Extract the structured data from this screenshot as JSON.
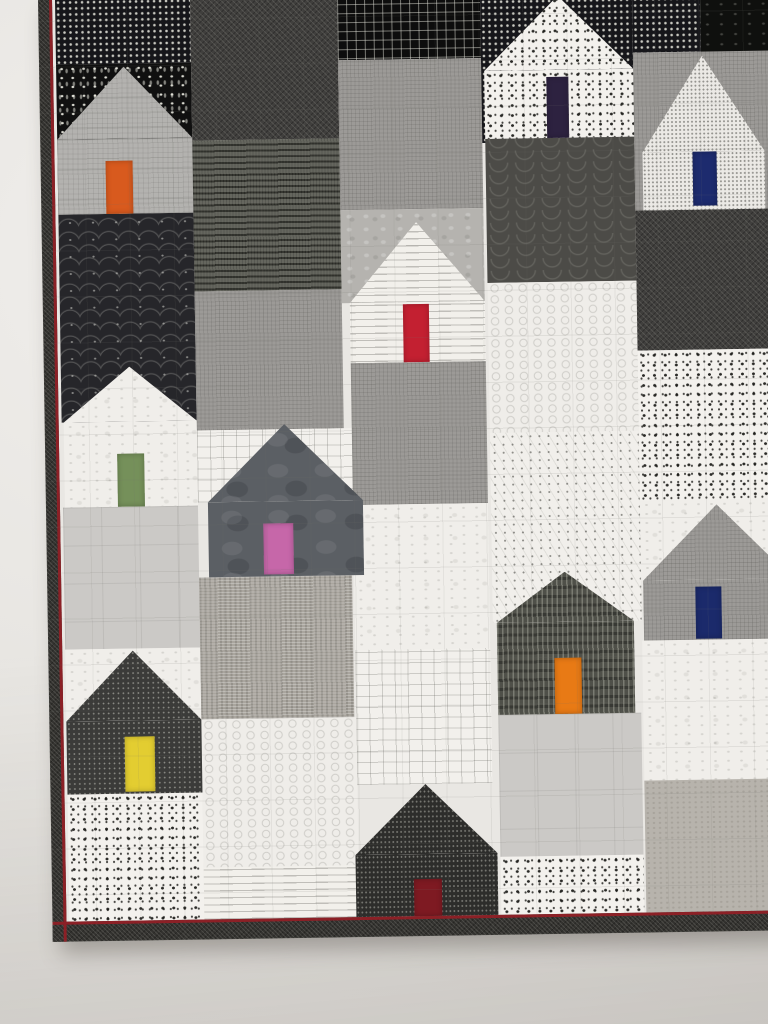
{
  "scene": {
    "description": "Photograph of a modern patchwork quilt hanging on a pale gray wall. The quilt is pieced from black, white and gray printed fabrics forming a village of house blocks; each house has one small bright solid-colored door. A dark binding with a thin dark-red accent line edges the quilt on the left and bottom.",
    "medium": "photograph",
    "subject": "house-block patchwork quilt",
    "text_content": "none"
  },
  "palette": {
    "wall": "#e7e5e1",
    "binding": "#33322f",
    "binding_accent": "#8c2026",
    "fabrics": [
      "#0d0d0d",
      "#16161a",
      "#3b3b39",
      "#45463f",
      "#5b5f64",
      "#9c9a97",
      "#b5b3af",
      "#cbc9c6",
      "#f0eeea",
      "#f3f1ed"
    ]
  },
  "houses": [
    {
      "id": "house-1",
      "position": "top-left",
      "body_fabric": "gray-crosshatch",
      "door_name": "orange",
      "door_color": "#d85a1e"
    },
    {
      "id": "house-2",
      "position": "top-center",
      "body_fabric": "white-with-black-dots",
      "door_name": "dark-plum",
      "door_color": "#2d2240"
    },
    {
      "id": "house-3",
      "position": "top-right",
      "body_fabric": "white-speckle",
      "door_name": "navy-blue",
      "door_color": "#1d2b6e"
    },
    {
      "id": "house-4",
      "position": "middle-left",
      "body_fabric": "white-grunge",
      "door_name": "moss-green",
      "door_color": "#75905a"
    },
    {
      "id": "house-5",
      "position": "center",
      "body_fabric": "white-text-print",
      "door_name": "red",
      "door_color": "#c32031"
    },
    {
      "id": "house-6",
      "position": "center-middle",
      "body_fabric": "slate-gray-batik",
      "door_name": "pink",
      "door_color": "#c667a9"
    },
    {
      "id": "house-7",
      "position": "middle-right",
      "body_fabric": "gray-linen",
      "door_name": "navy-blue",
      "door_color": "#1b2a6b"
    },
    {
      "id": "house-8",
      "position": "bottom-left",
      "body_fabric": "charcoal-speckle",
      "door_name": "yellow",
      "door_color": "#e3cd31"
    },
    {
      "id": "house-9",
      "position": "bottom-center",
      "body_fabric": "black-speckle",
      "door_name": "dark-red",
      "door_color": "#7e1a22"
    },
    {
      "id": "house-10",
      "position": "bottom-middle",
      "body_fabric": "dark-birch-print",
      "door_name": "orange",
      "door_color": "#e87a15"
    }
  ]
}
